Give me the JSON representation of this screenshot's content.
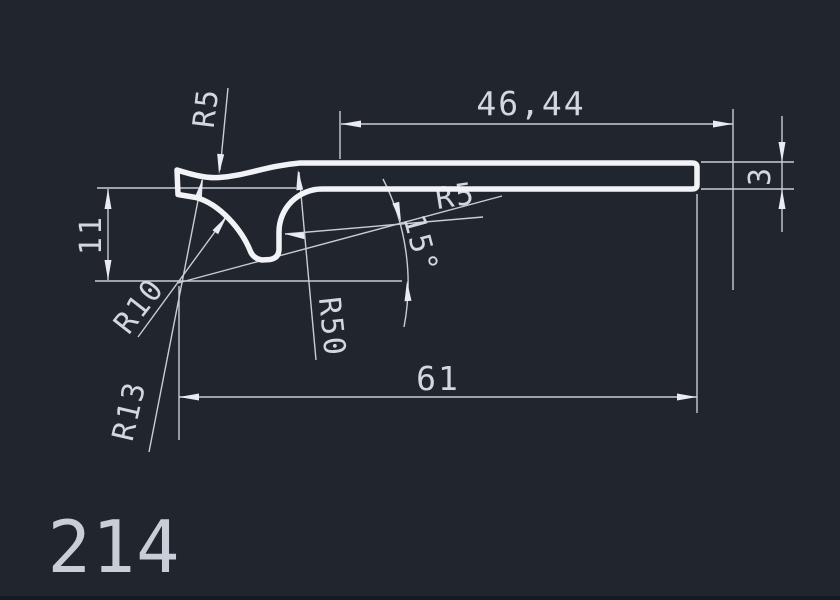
{
  "canvas": {
    "background_color": "#20252e",
    "line_color": "#f1f3f6",
    "dimension_color": "#c8cdd5"
  },
  "drawing": {
    "part_number": "214",
    "dimensions": {
      "top_width": "46,44",
      "bar_thickness": "3",
      "left_height": "11",
      "total_length": "61",
      "top_fillet_radius": "R5",
      "inner_fillet_radius": "R5",
      "angle": "15°",
      "sweep_radius": "R50",
      "concave_radius": "R10",
      "hook_radius": "R13"
    }
  }
}
